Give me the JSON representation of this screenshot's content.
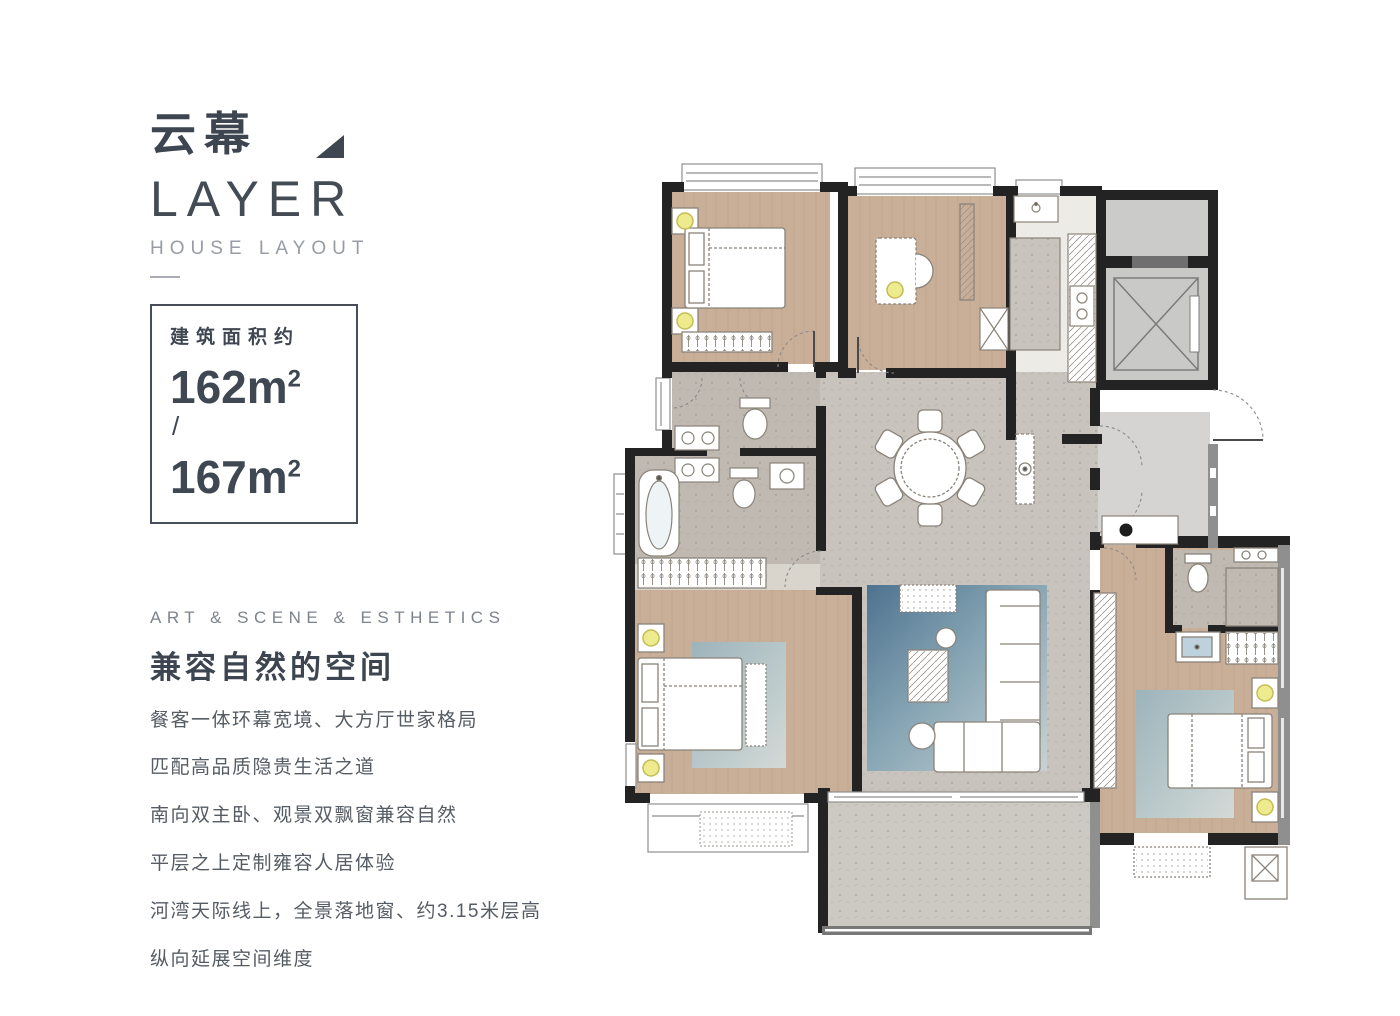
{
  "brand": {
    "title_zh": "云幕",
    "title_en": "LAYER",
    "subtitle": "HOUSE LAYOUT"
  },
  "area_box": {
    "label": "建筑面积约",
    "separator": "/",
    "areas": [
      {
        "value": "162",
        "unit": "m",
        "sup": "2"
      },
      {
        "value": "167",
        "unit": "m",
        "sup": "2"
      }
    ]
  },
  "intro": {
    "kicker": "ART & SCENE & ESTHETICS",
    "heading": "兼容自然的空间",
    "paragraphs": [
      "餐客一体环幕宽境、大方厅世家格局",
      "匹配高品质隐贵生活之道",
      "南向双主卧、观景双飘窗兼容自然",
      "平层之上定制雍容人居体验",
      "河湾天际线上，全景落地窗、约3.15米层高",
      "纵向延展空间维度"
    ]
  },
  "floor_plan": {
    "type": "residential-floor-plan",
    "colors": {
      "wall": "#232323",
      "wood_floor": "#c9af98",
      "stone_floor": "#c8c4bd",
      "tile_floor": "#bfb9b1",
      "core_gray": "#cbcbc9",
      "foyer_gray": "#d5d4d2",
      "rug_blue": "#4a7391",
      "lamp_yellow": "#eeeb8e",
      "accent_text": "#3e4651"
    }
  }
}
